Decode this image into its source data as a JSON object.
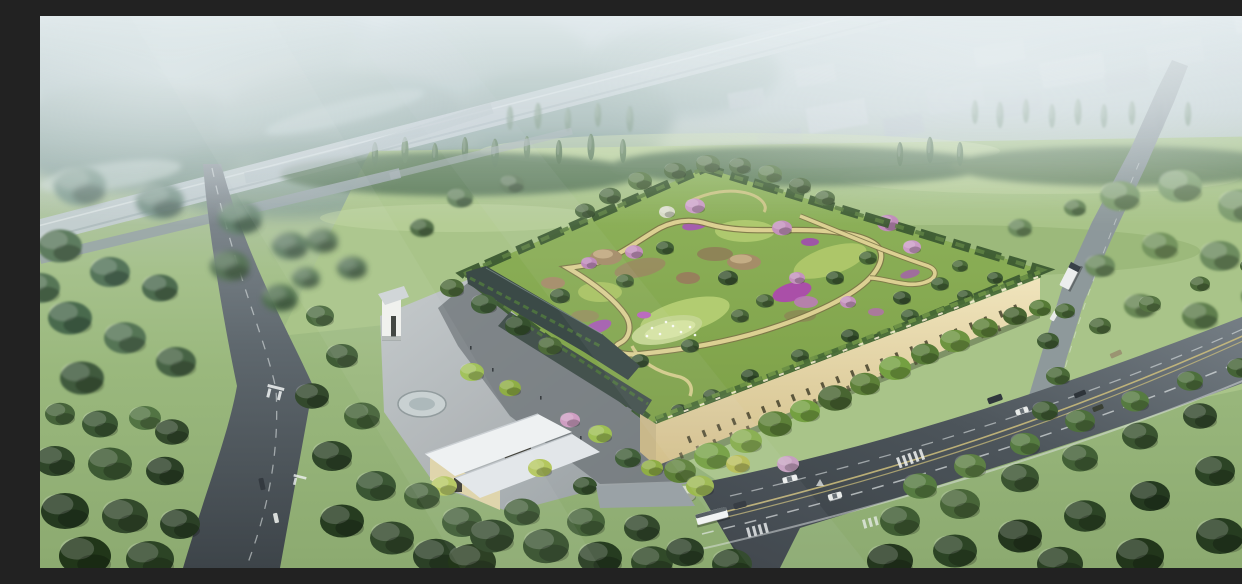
{
  "meta": {
    "type": "aerial-architectural-rendering",
    "description": "Aerial rendering of a rectangular facility with a lush rooftop garden park, a cream facade with slit windows, an entrance plaza with white-roofed pavilions, surrounded by dense forest, meadows, and two diagonal roads with light traffic under a hazy sky"
  },
  "palette": {
    "sky-top": "#b6c5cc",
    "mist-white": "#eaf1f3",
    "field-light": "#b7d099",
    "field-mid": "#9cba7e",
    "forest-dark": "#2c4425",
    "forest-mid": "#46633a",
    "forest-light": "#6f9450",
    "canopy-bright": "#8fb354",
    "roof-lawn": "#93b659",
    "roof-path": "#dcd092",
    "flower-purple": "#a55fae",
    "blossom-pink": "#c492bd",
    "facade-cream": "#e9dcb2",
    "window-dark": "#45422c",
    "wall-dark": "#3b4a47",
    "asphalt-dark": "#3c4348",
    "asphalt-mid": "#5a636a",
    "asphalt-light": "#8d979d",
    "plaza-grey": "#aab0b3",
    "white-roof": "#eef1f2",
    "marking-white": "#f0f3f3",
    "lane-yellow": "#cfc07c",
    "warehouse-grey": "#c3ccd2",
    "water-glass": "#c7cfd0"
  },
  "scene": {
    "objects": [
      "green-roof-building",
      "rooftop-garden",
      "entrance-plaza",
      "entrance-pavilion",
      "gate-tower",
      "round-water-feature",
      "left-road",
      "bottom-highway",
      "site-access-road",
      "distant-elevated-road",
      "warehouse-district",
      "meadow",
      "forest",
      "vehicles"
    ],
    "vehicle_colors": [
      "white",
      "dark-grey",
      "tan"
    ],
    "visible_text": ""
  }
}
